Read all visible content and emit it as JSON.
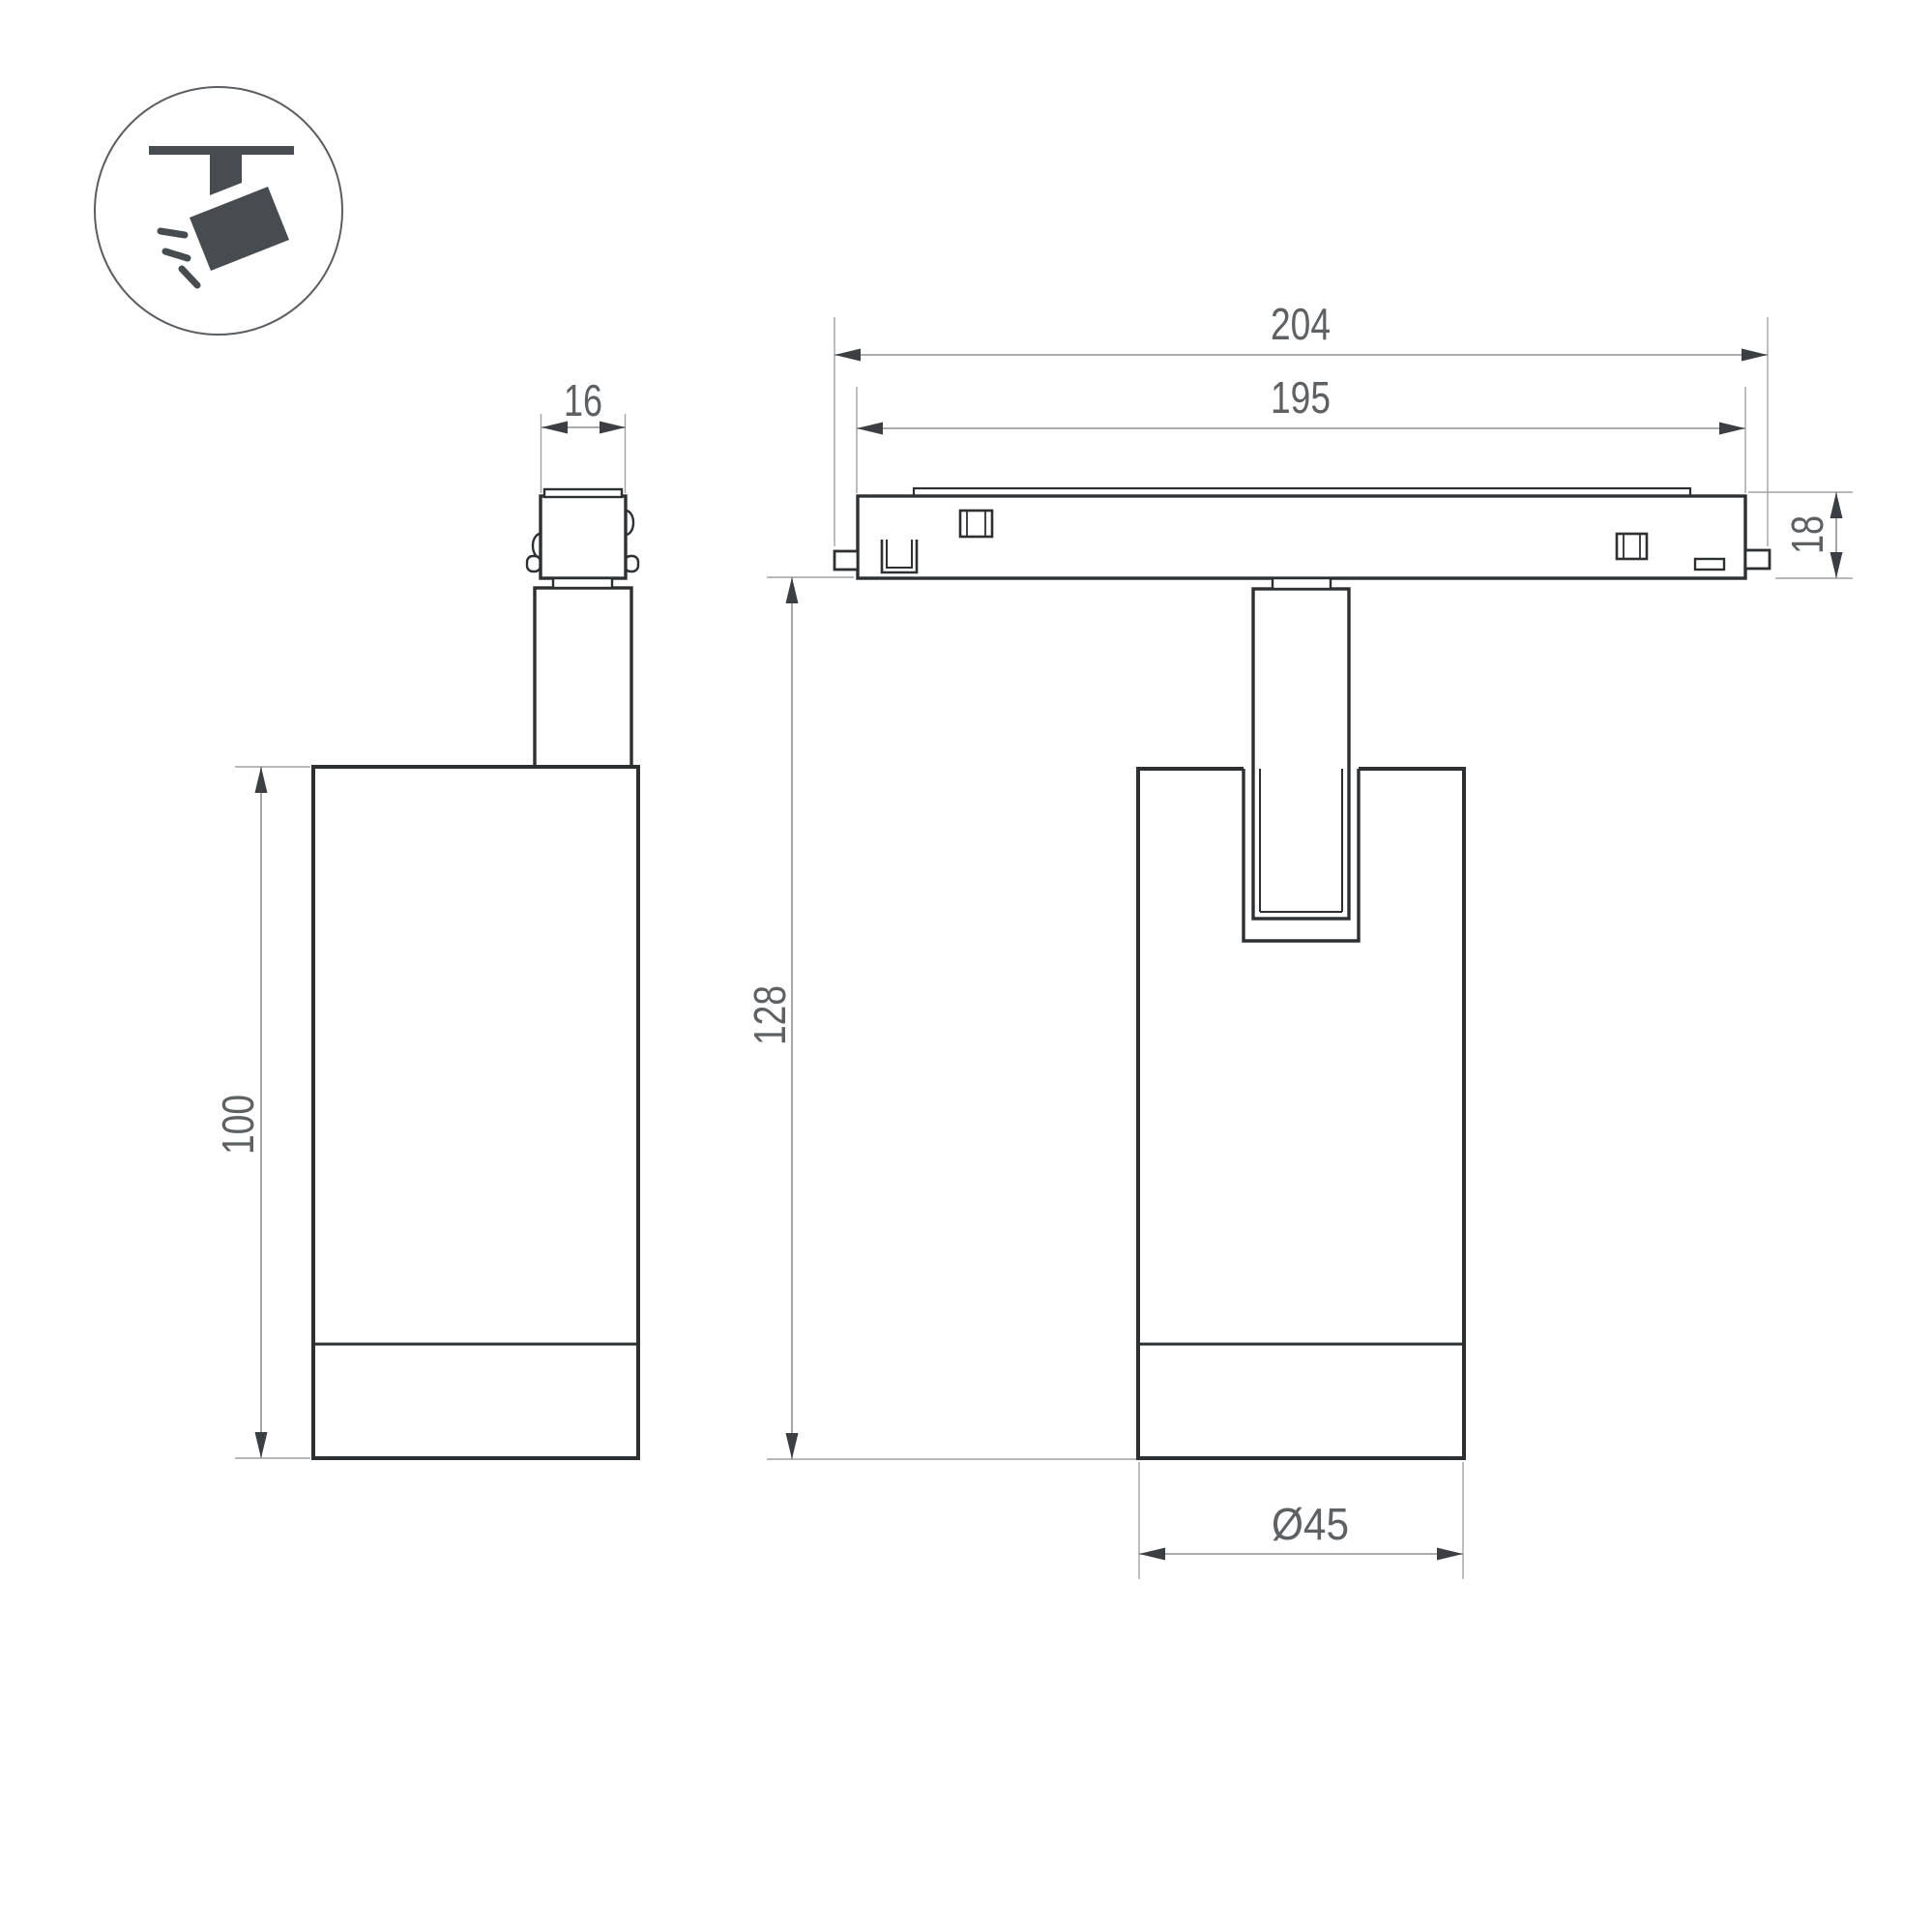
{
  "colors": {
    "background": "#ffffff",
    "outline": "#2d3033",
    "dimension_line": "#8f8f8f",
    "extension_line": "#a2a2a2",
    "arrowhead": "#3b3f43",
    "dimension_text": "#5d6164",
    "icon_glyph": "#474c51",
    "icon_circle_stroke": "#595e63"
  },
  "dimensions": {
    "connector_width": {
      "value": "16"
    },
    "body_height": {
      "value": "100"
    },
    "track_overall_length": {
      "value": "204"
    },
    "track_body_length": {
      "value": "195"
    },
    "track_height": {
      "value": "18"
    },
    "fixture_height": {
      "value": "128"
    },
    "body_diameter": {
      "value": "Ø45"
    }
  }
}
